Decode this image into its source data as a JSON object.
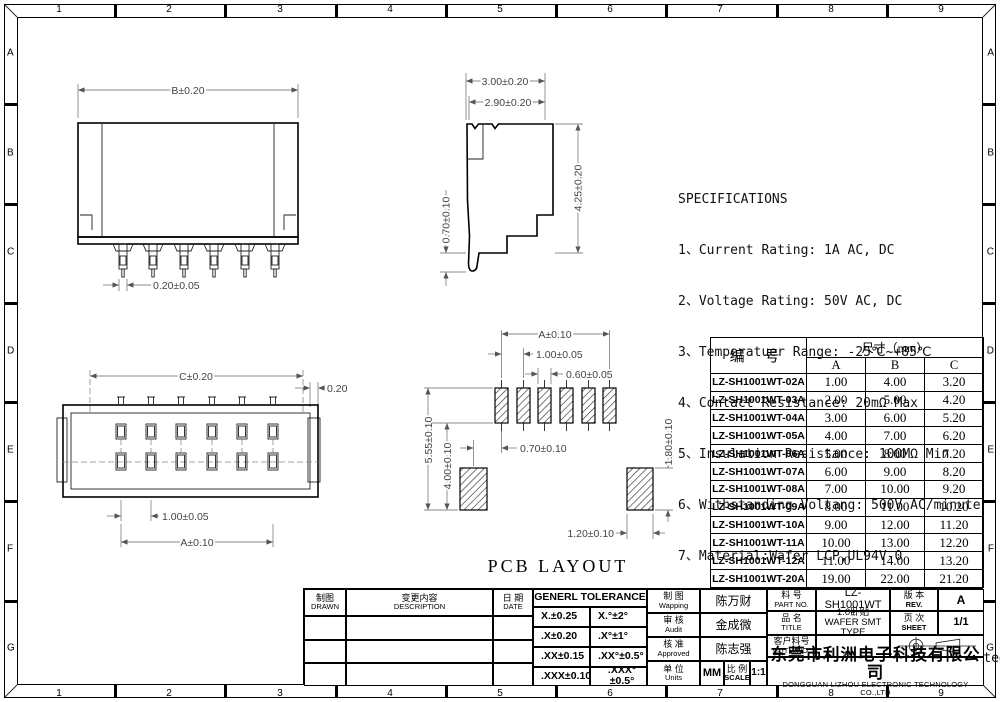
{
  "border": {
    "cols": [
      "1",
      "2",
      "3",
      "4",
      "5",
      "6",
      "7",
      "8",
      "9"
    ],
    "rows": [
      "A",
      "B",
      "C",
      "D",
      "E",
      "F",
      "G"
    ]
  },
  "specifications": {
    "title": "SPECIFICATIONS",
    "lines": [
      "1、Current Rating: 1A AC, DC",
      "2、Voltage Rating: 50V AC, DC",
      "3、Temperatuer Range: -25℃~+85℃",
      "4、Contact Resistance: 20mΩ Max",
      "5、Insulation Resistance: 100MΩ Min",
      "6、Withstanding Voltang: 500V AC/minute",
      "7、Material:Wafer LCP,UL94V-0",
      "   PIN Phosphoric bronze Tin-plated",
      "   Solder tad Phosphoric bronze Tin-plated"
    ]
  },
  "views": {
    "front": {
      "dim_width": "B±0.20",
      "dim_pin_width": "0.20±0.05"
    },
    "side": {
      "dim_depth_outer": "3.00±0.20",
      "dim_depth_inner": "2.90±0.20",
      "dim_height": "4.25±0.20",
      "dim_foot": "0.70±0.10"
    },
    "top": {
      "dim_width": "C±0.20",
      "dim_edge_gap": "0.20",
      "dim_pitch": "1.00±0.05",
      "dim_span": "A±0.10"
    },
    "pcb": {
      "title": "PCB LAYOUT",
      "dim_span": "A±0.10",
      "dim_pitch": "1.00±0.05",
      "dim_pad_width": "0.60±0.05",
      "dim_height_total": "5.55±0.10",
      "dim_height_inner": "4.00±0.10",
      "dim_offset": "0.70±0.10",
      "dim_side_pad_height": "1.80±0.10",
      "dim_side_pad_width": "1.20±0.10"
    }
  },
  "size_table": {
    "part_header": "编  号",
    "dim_header": "尺寸（mm）",
    "cols": [
      "A",
      "B",
      "C"
    ],
    "rows": [
      {
        "part": "LZ-SH1001WT-02A",
        "a": "1.00",
        "b": "4.00",
        "c": "3.20"
      },
      {
        "part": "LZ-SH1001WT-03A",
        "a": "2.00",
        "b": "5.00",
        "c": "4.20"
      },
      {
        "part": "LZ-SH1001WT-04A",
        "a": "3.00",
        "b": "6.00",
        "c": "5.20"
      },
      {
        "part": "LZ-SH1001WT-05A",
        "a": "4.00",
        "b": "7.00",
        "c": "6.20"
      },
      {
        "part": "LZ-SH1001WT-06A",
        "a": "5.00",
        "b": "8.00",
        "c": "7.20"
      },
      {
        "part": "LZ-SH1001WT-07A",
        "a": "6.00",
        "b": "9.00",
        "c": "8.20"
      },
      {
        "part": "LZ-SH1001WT-08A",
        "a": "7.00",
        "b": "10.00",
        "c": "9.20"
      },
      {
        "part": "LZ-SH1001WT-09A",
        "a": "8.00",
        "b": "11.00",
        "c": "10.20"
      },
      {
        "part": "LZ-SH1001WT-10A",
        "a": "9.00",
        "b": "12.00",
        "c": "11.20"
      },
      {
        "part": "LZ-SH1001WT-11A",
        "a": "10.00",
        "b": "13.00",
        "c": "12.20"
      },
      {
        "part": "LZ-SH1001WT-12A",
        "a": "11.00",
        "b": "14.00",
        "c": "13.20"
      },
      {
        "part": "LZ-SH1001WT-20A",
        "a": "19.00",
        "b": "22.00",
        "c": "21.20"
      }
    ]
  },
  "title_block": {
    "drawn": {
      "cn": "制图",
      "en": "DRAWN"
    },
    "description": {
      "cn": "变更内容",
      "en": "DESCRIPTION"
    },
    "date": {
      "cn": "日 期",
      "en": "DATE"
    },
    "tolerance": {
      "title": "GENERL TOLERANCE",
      "rows": [
        {
          "lin": "X.±0.25",
          "ang": "X.°±2°"
        },
        {
          "lin": ".X±0.20",
          "ang": ".X°±1°"
        },
        {
          "lin": ".XX±0.15",
          "ang": ".XX°±0.5°"
        },
        {
          "lin": ".XXX±0.10",
          "ang": ".XXX°±0.5°"
        }
      ]
    },
    "mapping": {
      "cn": "制 图",
      "en": "Wapping",
      "value": "陈万财"
    },
    "audit": {
      "cn": "审 核",
      "en": "Audit",
      "value": "金成微"
    },
    "approved": {
      "cn": "核 准",
      "en": "Approved",
      "value": "陈志强"
    },
    "units": {
      "cn": "单 位",
      "en": "Units",
      "value": "MM"
    },
    "scale": {
      "cn": "比 例",
      "en": "SCALE",
      "value": "1:1"
    },
    "part_no": {
      "cn": "料 号",
      "en": "PART NO.",
      "value": "LZ-SH1001WT"
    },
    "product": {
      "cn": "品 名",
      "en": "TITLE",
      "value_cn": "1.0卧贴",
      "value_en": "WAFER SMT TYPE"
    },
    "customer": {
      "cn": "客户料号",
      "en": "CUTM.NO.",
      "value": ""
    },
    "rev": {
      "cn": "版 本",
      "en": "REV.",
      "value": "A"
    },
    "sheet": {
      "cn": "页 次",
      "en": "SHEET",
      "value": "1/1"
    },
    "company": {
      "cn": "东莞市利洲电子科技有限公司",
      "en": "DONGGUAN LIZHOU ELECTRONIC TECHNOLOGY CO.,LTD"
    }
  }
}
